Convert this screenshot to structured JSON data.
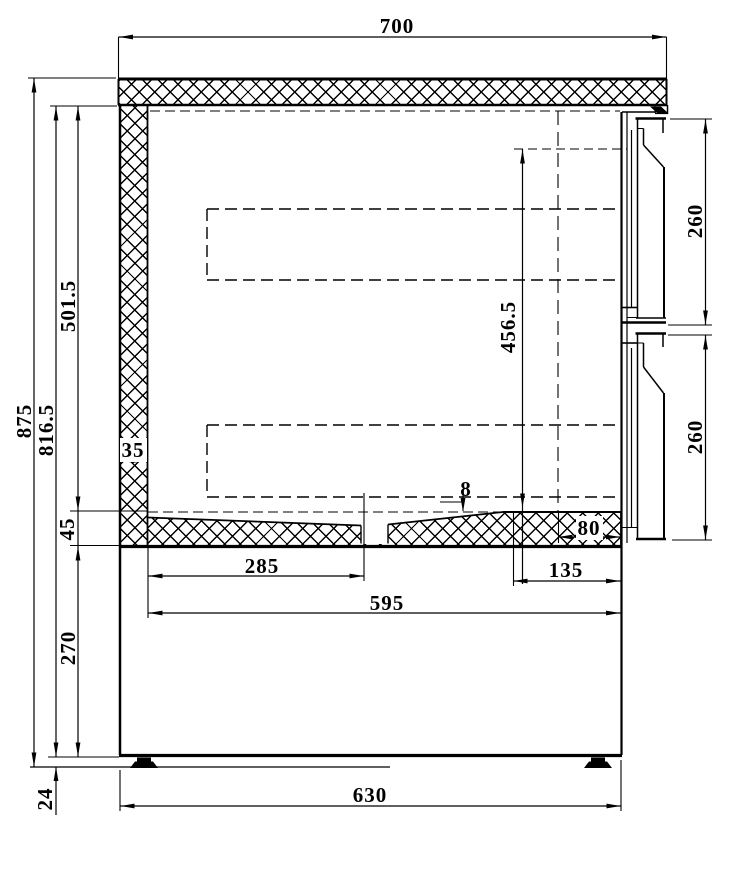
{
  "drawing": {
    "kind": "technical-section-drawing",
    "units": "mm",
    "labels": {
      "width_top": "700",
      "height_total": "875",
      "height_body": "816.5",
      "height_interior": "501.5",
      "wall_thickness": "35",
      "floor_thickness": "45",
      "height_base": "270",
      "height_feet": "24",
      "opening_height": "456.5",
      "drawer_top_height": "260",
      "drawer_bottom_height": "260",
      "floor_slope": "8",
      "tray_width": "80",
      "span_left_floor": "285",
      "span_right_floor": "135",
      "depth_interior": "595",
      "width_body": "630"
    },
    "colors": {
      "ink": "#000000",
      "paper": "#ffffff"
    }
  }
}
